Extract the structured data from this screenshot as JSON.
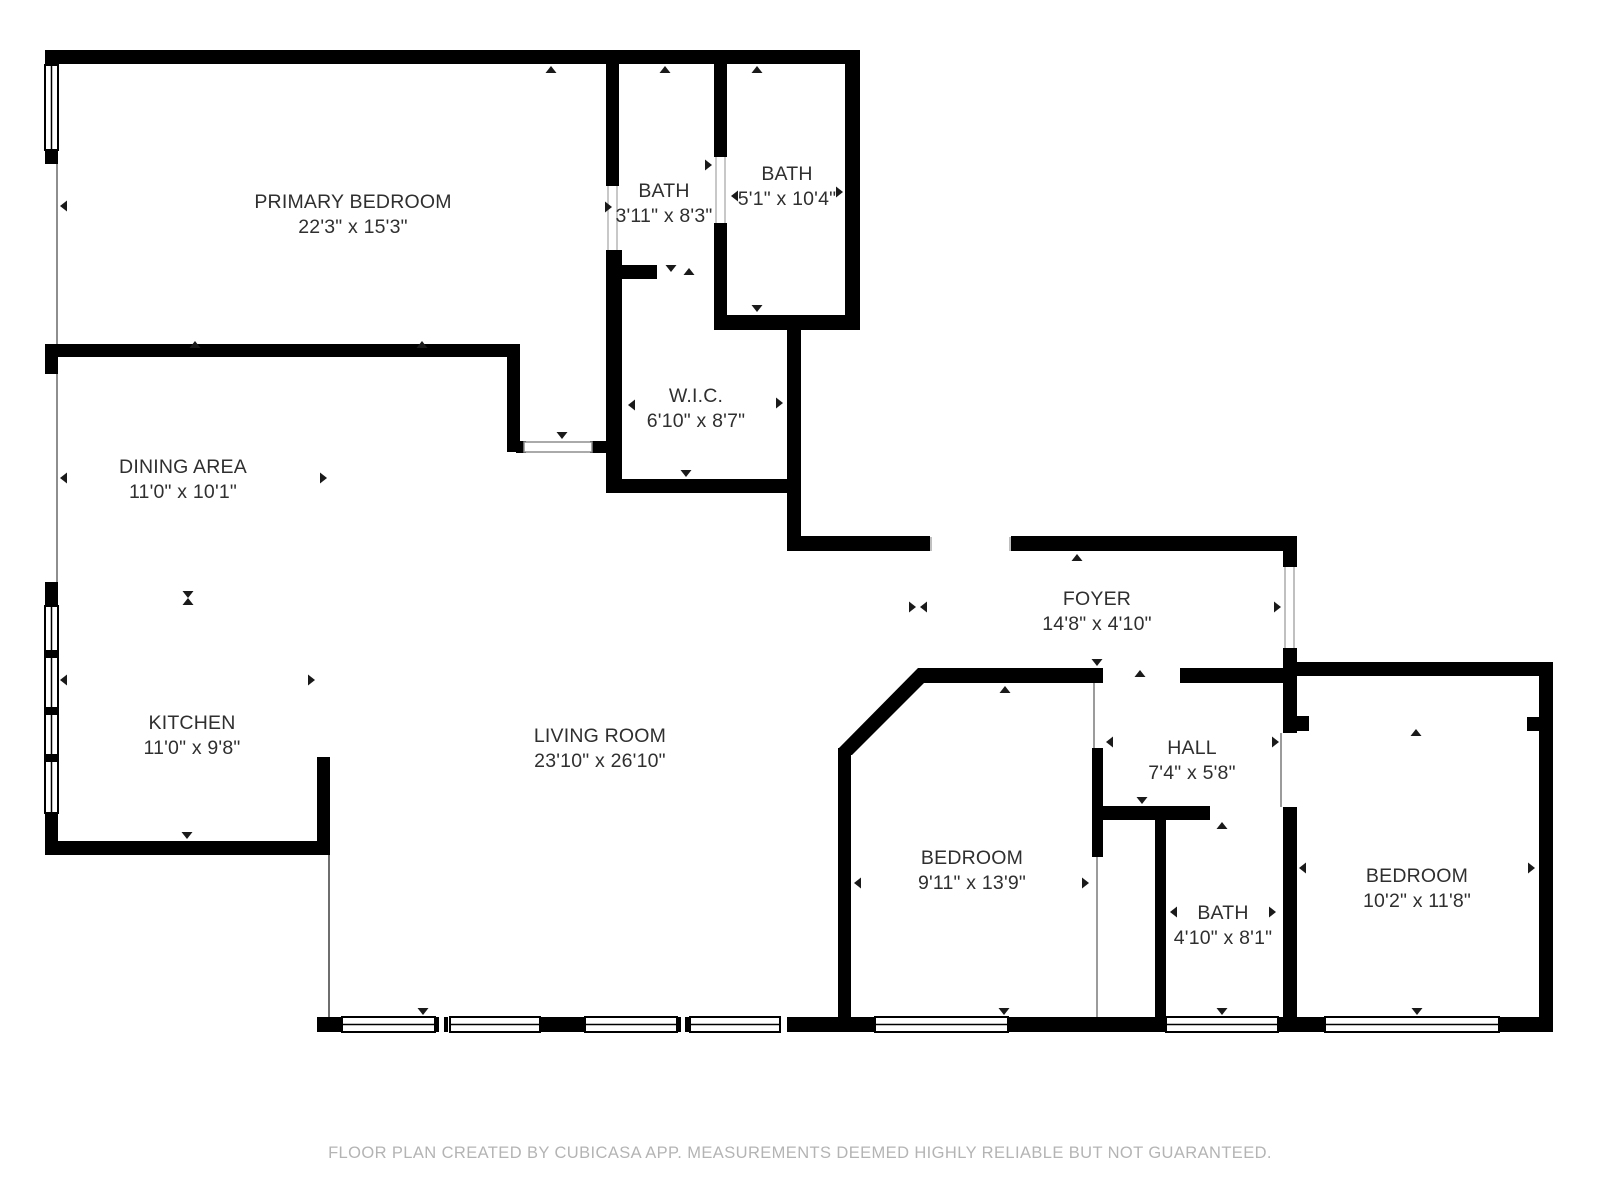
{
  "footer": "FLOOR PLAN CREATED BY CUBICASA APP. MEASUREMENTS DEEMED HIGHLY RELIABLE BUT NOT GUARANTEED.",
  "colors": {
    "wall": "#000000",
    "label": "#2f2f2f",
    "footer": "#b4b4b4",
    "tick": "#1a1a1a"
  },
  "rooms": [
    {
      "id": "primary-bedroom",
      "name": "PRIMARY BEDROOM",
      "dims": "22'3\" x 15'3\"",
      "cx": 353,
      "top": 190
    },
    {
      "id": "bath-primary-small",
      "name": "BATH",
      "dims": "3'11\" x 8'3\"",
      "cx": 664,
      "top": 179
    },
    {
      "id": "bath-primary-large",
      "name": "BATH",
      "dims": "5'1\" x 10'4\"",
      "cx": 787,
      "top": 162
    },
    {
      "id": "wic",
      "name": "W.I.C.",
      "dims": "6'10\" x 8'7\"",
      "cx": 696,
      "top": 384
    },
    {
      "id": "dining-area",
      "name": "DINING AREA",
      "dims": "11'0\" x 10'1\"",
      "cx": 183,
      "top": 455
    },
    {
      "id": "kitchen",
      "name": "KITCHEN",
      "dims": "11'0\" x 9'8\"",
      "cx": 192,
      "top": 711
    },
    {
      "id": "living-room",
      "name": "LIVING ROOM",
      "dims": "23'10\" x 26'10\"",
      "cx": 600,
      "top": 724
    },
    {
      "id": "foyer",
      "name": "FOYER",
      "dims": "14'8\" x 4'10\"",
      "cx": 1097,
      "top": 587
    },
    {
      "id": "hall",
      "name": "HALL",
      "dims": "7'4\" x 5'8\"",
      "cx": 1192,
      "top": 736
    },
    {
      "id": "bedroom-1",
      "name": "BEDROOM",
      "dims": "9'11\" x 13'9\"",
      "cx": 972,
      "top": 846
    },
    {
      "id": "bath-hall",
      "name": "BATH",
      "dims": "4'10\" x 8'1\"",
      "cx": 1223,
      "top": 901
    },
    {
      "id": "bedroom-2",
      "name": "BEDROOM",
      "dims": "10'2\" x 11'8\"",
      "cx": 1417,
      "top": 864
    }
  ]
}
